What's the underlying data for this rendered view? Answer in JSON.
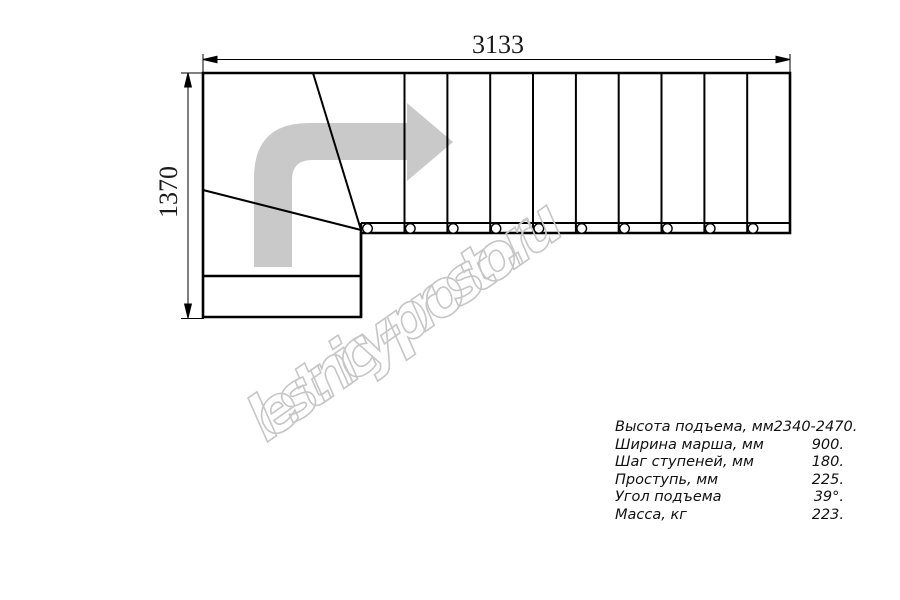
{
  "drawing": {
    "dimension_width_label": "3133",
    "dimension_height_label": "1370",
    "watermark_text": "lestnicy-prosto.ru",
    "colors": {
      "arrow": "#c9c9c9",
      "watermark": "#c6c6c6",
      "line": "#000000"
    }
  },
  "specs": {
    "rows": [
      {
        "label": "Высота подъема, мм",
        "value": "2340-2470."
      },
      {
        "label": "Ширина марша, мм",
        "value": "900."
      },
      {
        "label": "Шаг ступеней, мм",
        "value": "180."
      },
      {
        "label": "Проступь, мм",
        "value": "225."
      },
      {
        "label": "Угол подъема",
        "value": "39°."
      },
      {
        "label": "Масса, кг",
        "value": "223."
      }
    ]
  }
}
